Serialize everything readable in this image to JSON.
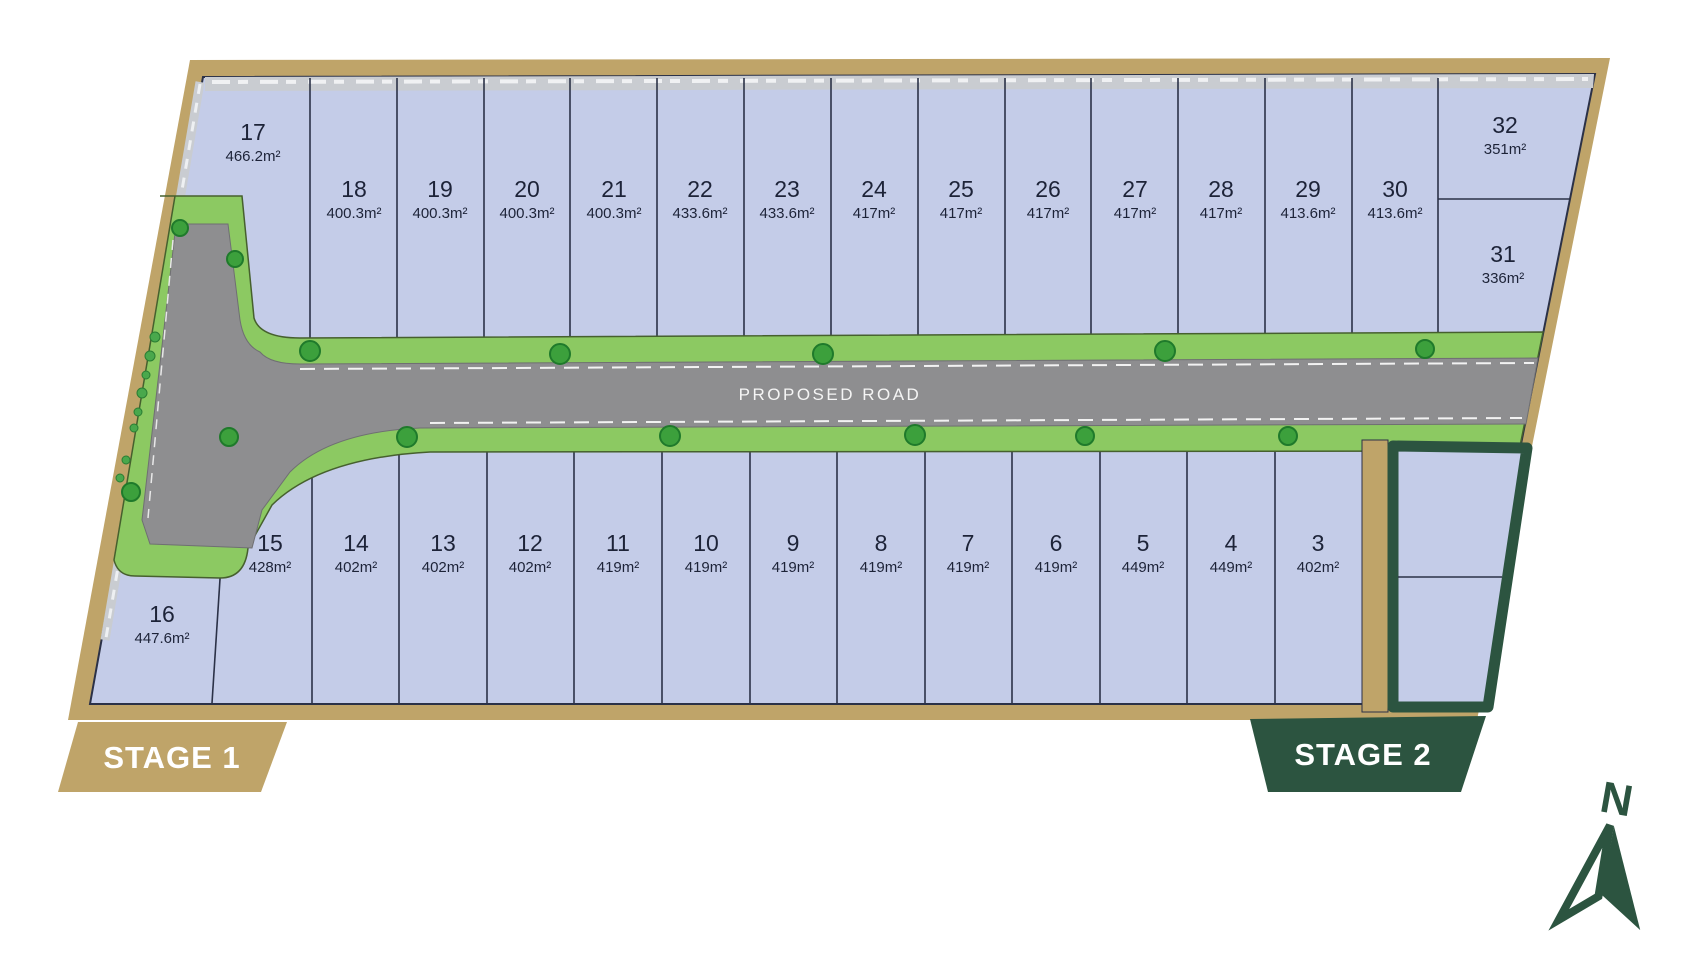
{
  "title": "Subdivision site plan",
  "road": {
    "label": "PROPOSED ROAD"
  },
  "stages": {
    "stage1": "STAGE 1",
    "stage2": "STAGE 2"
  },
  "compass": {
    "label": "N"
  },
  "lots": {
    "top_row": [
      {
        "num": "17",
        "area": "466.2m²"
      },
      {
        "num": "18",
        "area": "400.3m²"
      },
      {
        "num": "19",
        "area": "400.3m²"
      },
      {
        "num": "20",
        "area": "400.3m²"
      },
      {
        "num": "21",
        "area": "400.3m²"
      },
      {
        "num": "22",
        "area": "433.6m²"
      },
      {
        "num": "23",
        "area": "433.6m²"
      },
      {
        "num": "24",
        "area": "417m²"
      },
      {
        "num": "25",
        "area": "417m²"
      },
      {
        "num": "26",
        "area": "417m²"
      },
      {
        "num": "27",
        "area": "417m²"
      },
      {
        "num": "28",
        "area": "417m²"
      },
      {
        "num": "29",
        "area": "413.6m²"
      },
      {
        "num": "30",
        "area": "413.6m²"
      }
    ],
    "right_column": [
      {
        "num": "32",
        "area": "351m²"
      },
      {
        "num": "31",
        "area": "336m²"
      }
    ],
    "bottom_row": [
      {
        "num": "16",
        "area": "447.6m²"
      },
      {
        "num": "15",
        "area": "428m²"
      },
      {
        "num": "14",
        "area": "402m²"
      },
      {
        "num": "13",
        "area": "402m²"
      },
      {
        "num": "12",
        "area": "402m²"
      },
      {
        "num": "11",
        "area": "419m²"
      },
      {
        "num": "10",
        "area": "419m²"
      },
      {
        "num": "9",
        "area": "419m²"
      },
      {
        "num": "8",
        "area": "419m²"
      },
      {
        "num": "7",
        "area": "419m²"
      },
      {
        "num": "6",
        "area": "419m²"
      },
      {
        "num": "5",
        "area": "449m²"
      },
      {
        "num": "4",
        "area": "449m²"
      },
      {
        "num": "3",
        "area": "402m²"
      }
    ],
    "stage2_lots": [
      {
        "num": "1",
        "area": "347m²"
      },
      {
        "num": "2",
        "area": "346m²"
      }
    ]
  },
  "colors": {
    "boundary_tan": "#bfa469",
    "lot_fill": "#c4cce8",
    "lot_line": "#2b3147",
    "verge_green": "#8cc962",
    "road_gray": "#8e8e90",
    "tree_green": "#3ca03c",
    "stage2_green": "#2c5440",
    "label_navy": "#1d2338"
  }
}
